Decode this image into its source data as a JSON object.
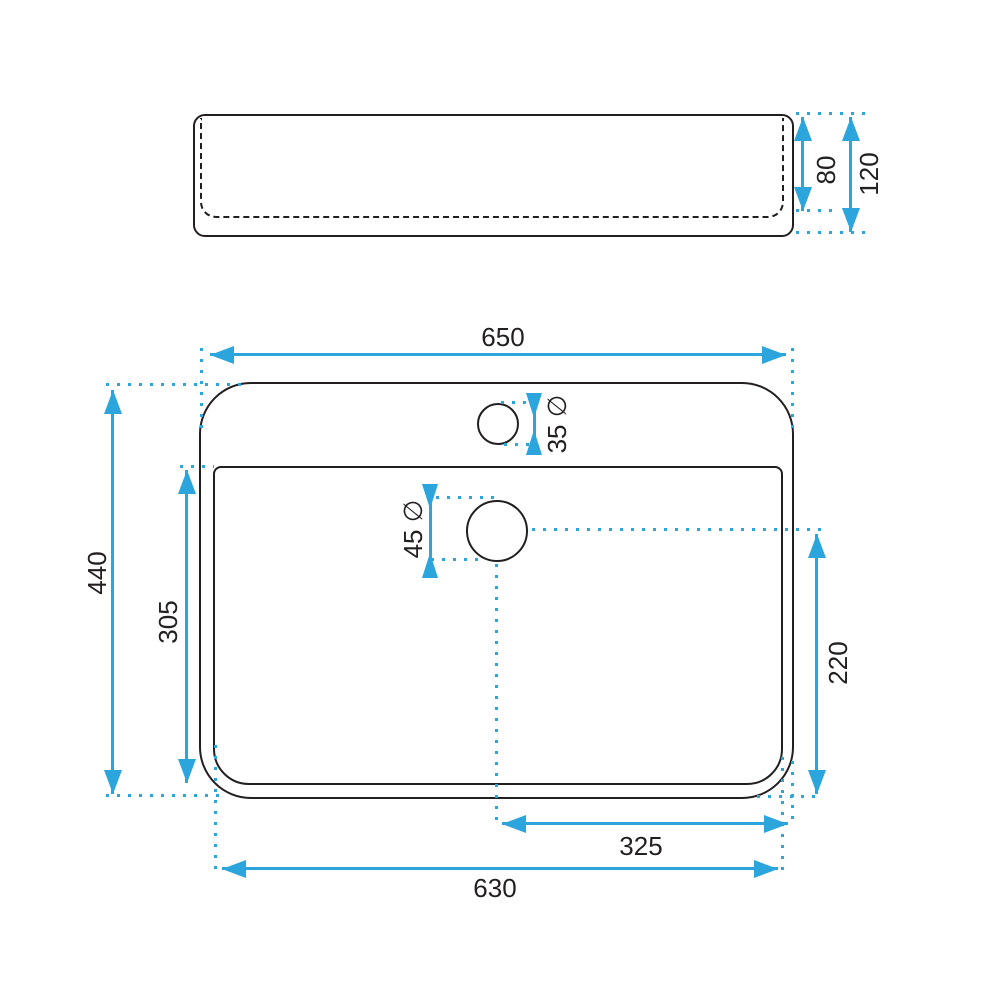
{
  "title": "Washbasin technical dimension drawing",
  "colors": {
    "accent": "#2BA5DC",
    "line": "#231F20",
    "background": "#FFFFFF"
  },
  "side_view": {
    "description": "front profile of basin",
    "dimensions": {
      "inner_depth": "80",
      "overall_height": "120"
    }
  },
  "plan_view": {
    "description": "top plan of basin",
    "dimensions": {
      "overall_width": "650",
      "overall_depth": "440",
      "inner_depth": "305",
      "faucet_hole_diameter": "35 ∅",
      "drain_hole_diameter": "45 ∅",
      "drain_to_back_edge": "220",
      "drain_center_to_right_edge": "325",
      "inner_width": "630"
    }
  }
}
